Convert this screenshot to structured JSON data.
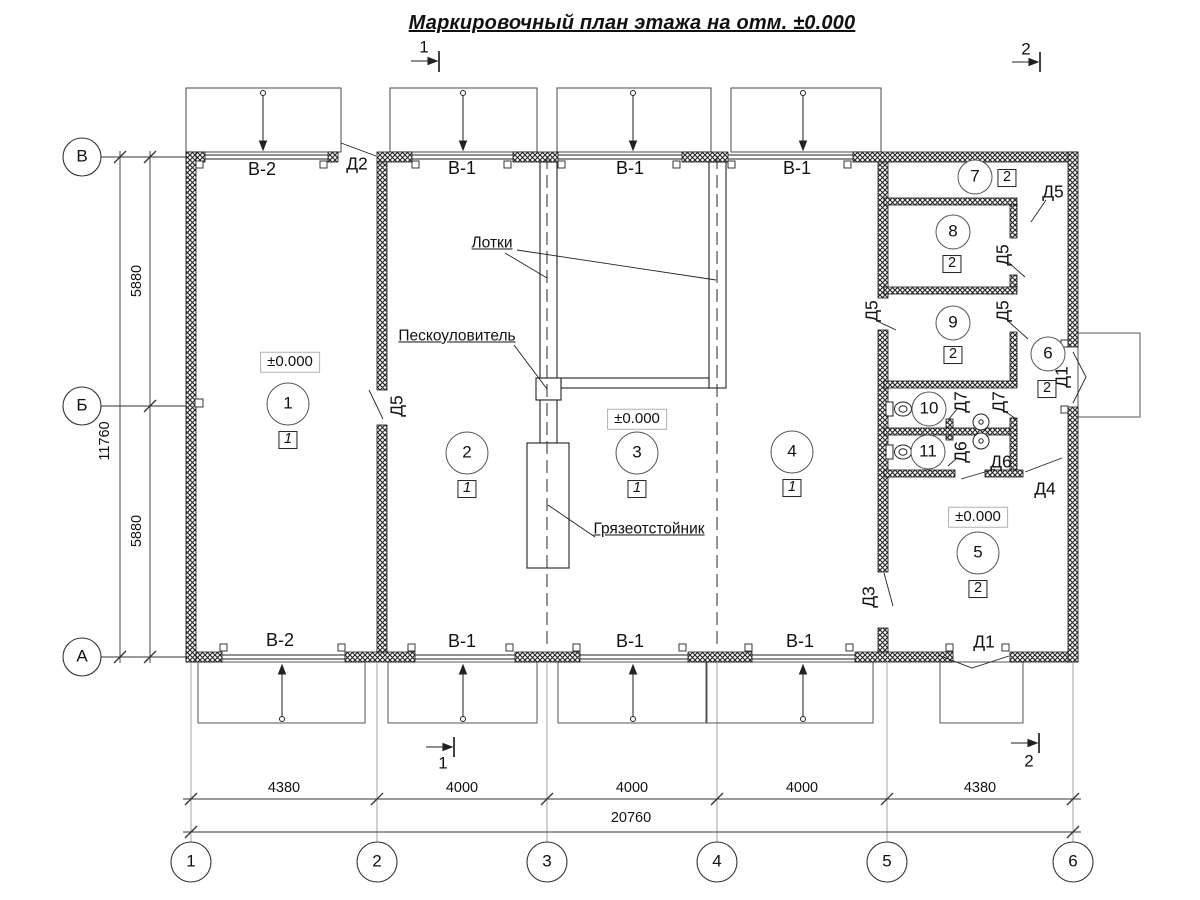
{
  "title": "Маркировочный план этажа на отм. ±0.000",
  "section_markers": {
    "s1": "1",
    "s2": "2"
  },
  "axis_rows": [
    "В",
    "Б",
    "А"
  ],
  "axis_cols": [
    "1",
    "2",
    "3",
    "4",
    "5",
    "6"
  ],
  "dims": {
    "v_overall": "11760",
    "v_top": "5880",
    "v_bottom": "5880",
    "h_segments": [
      "4380",
      "4000",
      "4000",
      "4000",
      "4380"
    ],
    "h_overall": "20760"
  },
  "windows": {
    "b2": "В-2",
    "b1": "В-1"
  },
  "doors": {
    "d1": "Д1",
    "d2": "Д2",
    "d3": "Д3",
    "d4": "Д4",
    "d5": "Д5",
    "d6": "Д6",
    "d7": "Д7"
  },
  "rooms": [
    {
      "n": "1",
      "f": "1"
    },
    {
      "n": "2",
      "f": "1"
    },
    {
      "n": "3",
      "f": "1"
    },
    {
      "n": "4",
      "f": "1"
    },
    {
      "n": "5",
      "f": "2"
    },
    {
      "n": "6",
      "f": "2"
    },
    {
      "n": "7",
      "f": "2"
    },
    {
      "n": "8",
      "f": "2"
    },
    {
      "n": "9",
      "f": "2"
    },
    {
      "n": "10"
    },
    {
      "n": "11"
    }
  ],
  "elevation": "±0.000",
  "annotations": {
    "trays": "Лотки",
    "sand_trap": "Пескоуловитель",
    "mud_settler": "Грязеотстойник"
  }
}
